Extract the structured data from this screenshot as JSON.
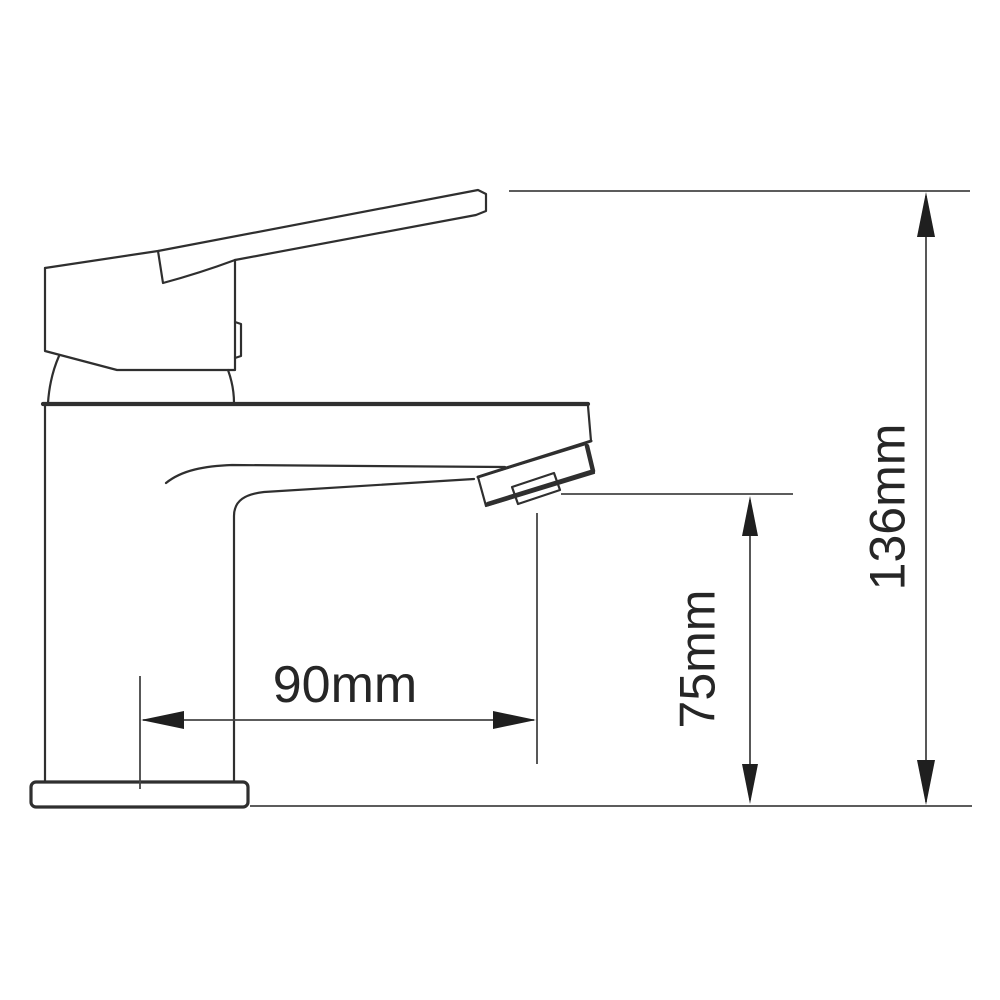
{
  "figure": {
    "type": "technical-dimension-drawing",
    "subject": "basin mixer tap side view",
    "background_color": "#ffffff",
    "outline_color": "#2f2f2f",
    "dimension_line_color": "#454545",
    "arrow_color": "#1f1f1f",
    "text_color": "#262626",
    "dimensions": {
      "width": {
        "label": "90mm",
        "value": 90,
        "unit": "mm"
      },
      "spout_height": {
        "label": "75mm",
        "value": 75,
        "unit": "mm"
      },
      "overall_height": {
        "label": "136mm",
        "value": 136,
        "unit": "mm"
      }
    }
  }
}
